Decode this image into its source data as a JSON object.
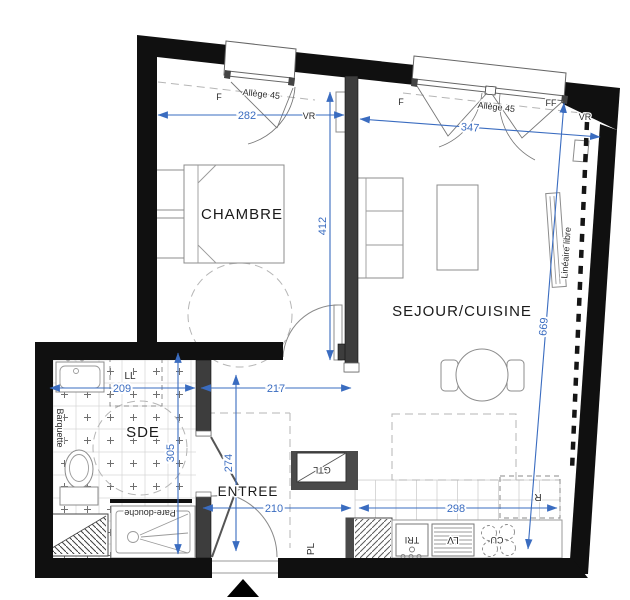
{
  "plan": {
    "rooms": {
      "chambre": "CHAMBRE",
      "sejour_cuisine": "SEJOUR/CUISINE",
      "sde": "SDE",
      "entree": "ENTREE"
    },
    "window_chambre": {
      "f": "F",
      "allege": "Allège 45",
      "vr": "VR"
    },
    "window_sejour": {
      "f": "F",
      "allege": "Allège 45",
      "ff": "FF",
      "vr": "VR"
    },
    "fixtures": {
      "ll": "LL",
      "barquette": "Barquette",
      "pare_douche": "Pare-douche",
      "gtl": "GTL",
      "pl": "PL",
      "tri": "TRI",
      "lv": "LV",
      "cu": "CU",
      "r": "R",
      "lineaire_libre": "Linéaire libre"
    },
    "dimensions_cm": {
      "chambre_width": "282",
      "sejour_width": "347",
      "chambre_depth": "412",
      "chambre_south": "217",
      "sde_width": "209",
      "sde_depth": "305",
      "entree_depth": "274",
      "entree_width": "210",
      "kitchen_run": "298",
      "sejour_depth": "669"
    },
    "colors": {
      "dimension_blue": "#3a6cc0",
      "wall_black": "#101010"
    }
  }
}
